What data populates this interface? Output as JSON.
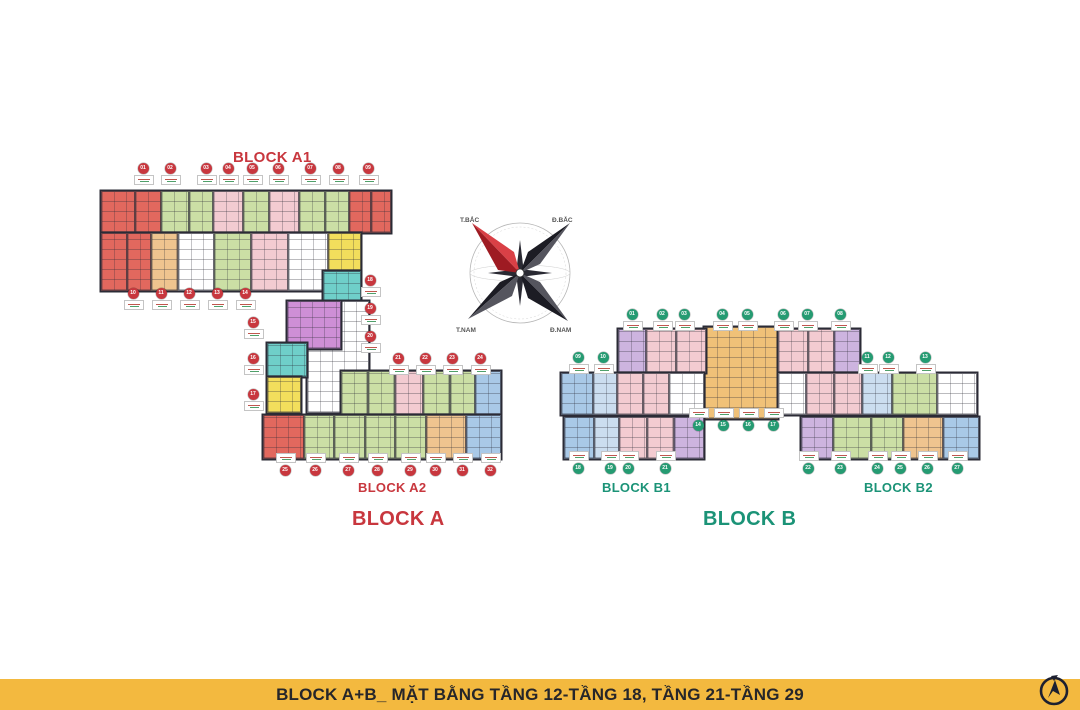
{
  "slide": {
    "background": "#ffffff"
  },
  "footer": {
    "title": "BLOCK A+B_ MẶT BẰNG TẦNG 12-TẦNG 18, TẦNG 21-TẦNG 29",
    "bg": "#F3B93F",
    "text_color": "#26262A"
  },
  "labels": {
    "block_a1": "BLOCK A1",
    "block_a2": "BLOCK A2",
    "block_a": "BLOCK A",
    "block_b1": "BLOCK B1",
    "block_b2": "BLOCK B2",
    "block_b": "BLOCK B",
    "color_a": "#C8373E",
    "color_b": "#1B9377"
  },
  "compass": {
    "nw": "T.BẮC",
    "ne": "Đ.BẮC",
    "sw": "T.NAM",
    "se": "Đ.NAM",
    "needle_color": "#C32A31"
  },
  "palette": {
    "red": "#E2685E",
    "green": "#CBDFA5",
    "pink": "#F3CBD1",
    "magenta": "#CE8FD6",
    "lavender": "#CDB4DF",
    "teal": "#6FCFC9",
    "yellow": "#F2DE5C",
    "tan": "#EFC48F",
    "orange": "#F0C178",
    "blue": "#A9C9E7",
    "lightblue": "#CBDDEF",
    "white": "#FFFFFF"
  },
  "marker_colors": {
    "a": "#C8373E",
    "b": "#259B72"
  },
  "floorplan": {
    "strips": [
      {
        "x": 100,
        "y": 190,
        "h": 42,
        "units": [
          [
            "red",
            34
          ],
          [
            "red",
            26
          ],
          [
            "green",
            28
          ],
          [
            "green",
            24
          ],
          [
            "pink",
            30
          ],
          [
            "green",
            26
          ],
          [
            "pink",
            30
          ],
          [
            "green",
            26
          ],
          [
            "green",
            24
          ],
          [
            "red",
            22
          ],
          [
            "red",
            20
          ]
        ]
      },
      {
        "x": 100,
        "y": 232,
        "h": 58,
        "units": [
          [
            "red",
            26
          ],
          [
            "red",
            24
          ],
          [
            "tan",
            27
          ],
          [
            "white",
            36
          ],
          [
            "green",
            37
          ],
          [
            "pink",
            37
          ],
          [
            "white",
            40
          ],
          [
            "yellow",
            33
          ]
        ]
      },
      {
        "x": 322,
        "y": 270,
        "h": 34,
        "units": [
          [
            "teal",
            38
          ]
        ]
      },
      {
        "x": 306,
        "y": 300,
        "h": 112,
        "units": [
          [
            "white",
            62
          ]
        ]
      },
      {
        "x": 286,
        "y": 300,
        "h": 48,
        "units": [
          [
            "magenta",
            54
          ]
        ]
      },
      {
        "x": 266,
        "y": 342,
        "h": 34,
        "units": [
          [
            "teal",
            40
          ]
        ]
      },
      {
        "x": 266,
        "y": 376,
        "h": 36,
        "units": [
          [
            "yellow",
            34
          ]
        ]
      },
      {
        "x": 340,
        "y": 370,
        "h": 44,
        "units": [
          [
            "green",
            27
          ],
          [
            "green",
            27
          ],
          [
            "pink",
            28
          ],
          [
            "green",
            27
          ],
          [
            "green",
            25
          ],
          [
            "blue",
            26
          ]
        ]
      },
      {
        "x": 262,
        "y": 414,
        "h": 44,
        "units": [
          [
            "red",
            41
          ],
          [
            "green",
            30
          ],
          [
            "green",
            31
          ],
          [
            "green",
            30
          ],
          [
            "green",
            31
          ],
          [
            "tan",
            40
          ],
          [
            "blue",
            35
          ]
        ]
      },
      {
        "x": 703,
        "y": 326,
        "h": 92,
        "units": [
          [
            "orange",
            74
          ]
        ]
      },
      {
        "x": 617,
        "y": 328,
        "h": 44,
        "units": [
          [
            "lavender",
            28
          ],
          [
            "pink",
            30
          ],
          [
            "pink",
            30
          ]
        ]
      },
      {
        "x": 777,
        "y": 328,
        "h": 44,
        "units": [
          [
            "pink",
            30
          ],
          [
            "pink",
            26
          ],
          [
            "lavender",
            26
          ]
        ]
      },
      {
        "x": 560,
        "y": 372,
        "h": 42,
        "units": [
          [
            "blue",
            32
          ],
          [
            "lightblue",
            24
          ],
          [
            "pink",
            26
          ],
          [
            "pink",
            26
          ],
          [
            "white",
            35
          ]
        ]
      },
      {
        "x": 777,
        "y": 372,
        "h": 42,
        "units": [
          [
            "white",
            28
          ],
          [
            "pink",
            28
          ],
          [
            "pink",
            28
          ],
          [
            "lightblue",
            30
          ],
          [
            "green",
            45
          ],
          [
            "white",
            40
          ]
        ]
      },
      {
        "x": 563,
        "y": 416,
        "h": 42,
        "units": [
          [
            "blue",
            30
          ],
          [
            "lightblue",
            25
          ],
          [
            "pink",
            28
          ],
          [
            "pink",
            27
          ],
          [
            "lavender",
            30
          ]
        ]
      },
      {
        "x": 800,
        "y": 416,
        "h": 42,
        "units": [
          [
            "lavender",
            32
          ],
          [
            "green",
            38
          ],
          [
            "green",
            32
          ],
          [
            "tan",
            40
          ],
          [
            "blue",
            36
          ]
        ]
      }
    ],
    "markers": [
      {
        "color": "a",
        "y": 168,
        "label": "below",
        "n0": 1,
        "xs": [
          143,
          170,
          206,
          228,
          252,
          278,
          310,
          338,
          368
        ]
      },
      {
        "color": "a",
        "y": 293,
        "label": "below",
        "n0": 10,
        "xs": [
          133,
          161,
          189,
          217,
          245
        ]
      },
      {
        "color": "a",
        "x": 253,
        "label": "below",
        "n0": 15,
        "ys": [
          322,
          358,
          394
        ]
      },
      {
        "color": "a",
        "x": 370,
        "label": "below",
        "n0": 18,
        "ys": [
          280,
          308,
          336
        ]
      },
      {
        "color": "a",
        "y": 358,
        "label": "below",
        "n0": 21,
        "xs": [
          398,
          425,
          452,
          480
        ]
      },
      {
        "color": "a",
        "y": 470,
        "label": "above",
        "n0": 25,
        "xs": [
          285,
          315,
          348,
          377,
          410,
          435,
          462,
          490
        ]
      },
      {
        "color": "b",
        "y": 314,
        "label": "below",
        "n0": 1,
        "xs": [
          632,
          662,
          684,
          722,
          747,
          783,
          807,
          840
        ]
      },
      {
        "color": "b",
        "y": 357,
        "label": "below",
        "n0": 9,
        "xs": [
          578,
          603
        ]
      },
      {
        "color": "b",
        "y": 357,
        "label": "below",
        "n0": 11,
        "xs": [
          867,
          888,
          925
        ]
      },
      {
        "color": "b",
        "y": 425,
        "label": "above",
        "n0": 14,
        "xs": [
          698,
          723,
          748,
          773
        ]
      },
      {
        "color": "b",
        "y": 468,
        "label": "above",
        "n0": 18,
        "xs": [
          578,
          610,
          628,
          665
        ]
      },
      {
        "color": "b",
        "y": 468,
        "label": "above",
        "n0": 22,
        "xs": [
          808,
          840,
          877,
          900,
          927,
          957
        ]
      }
    ]
  }
}
